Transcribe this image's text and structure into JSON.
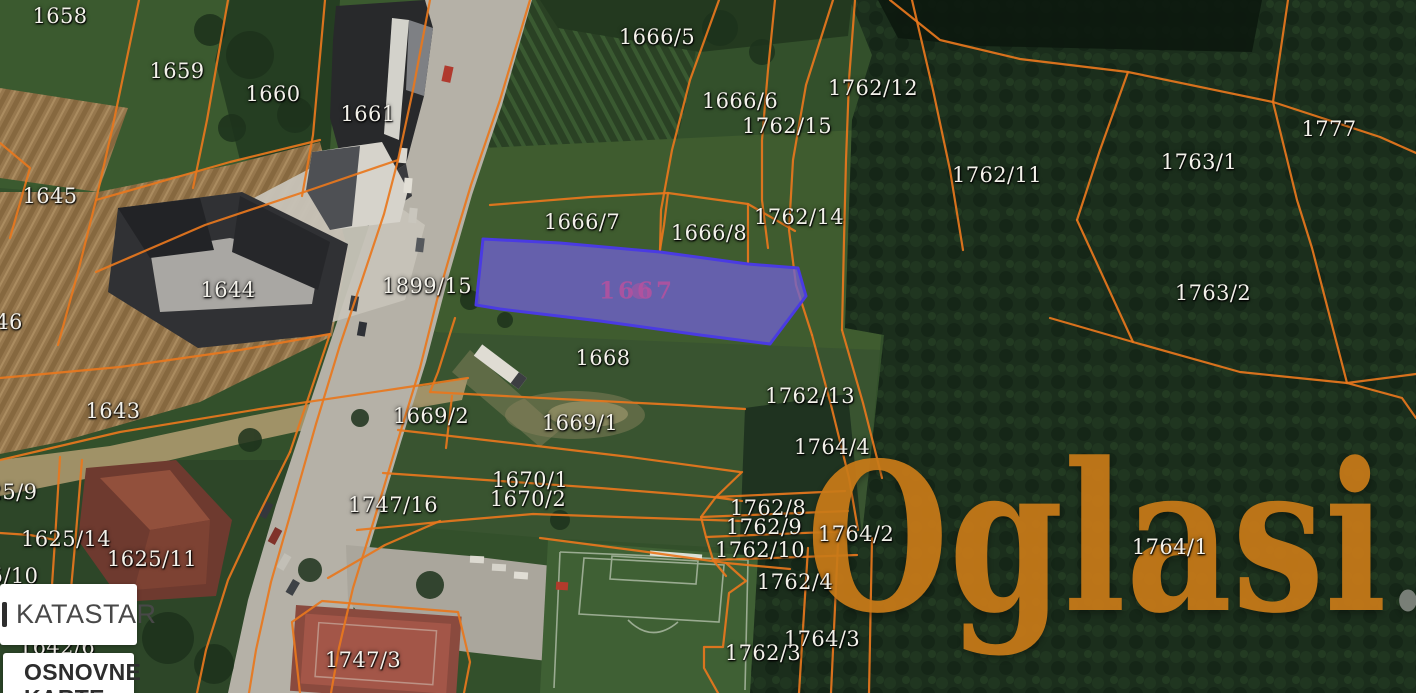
{
  "map": {
    "boundary_color": "#e8771d",
    "label_color": "#f3f1ea",
    "parcel_labels": [
      {
        "id": "1658",
        "x": 60,
        "y": 16
      },
      {
        "id": "1659",
        "x": 177,
        "y": 71
      },
      {
        "id": "1660",
        "x": 273,
        "y": 94
      },
      {
        "id": "1661",
        "x": 368,
        "y": 114
      },
      {
        "id": "1645",
        "x": 50,
        "y": 196
      },
      {
        "id": "46",
        "x": 9,
        "y": 322
      },
      {
        "id": "1644",
        "x": 228,
        "y": 290
      },
      {
        "id": "1899/15",
        "x": 427,
        "y": 286
      },
      {
        "id": "1643",
        "x": 113,
        "y": 411
      },
      {
        "id": "25/9",
        "x": 13,
        "y": 492
      },
      {
        "id": "1625/14",
        "x": 66,
        "y": 539
      },
      {
        "id": "1625/11",
        "x": 152,
        "y": 559
      },
      {
        "id": "5/10",
        "x": 14,
        "y": 576
      },
      {
        "id": "1642/6",
        "x": 57,
        "y": 647
      },
      {
        "id": "1666/5",
        "x": 657,
        "y": 37
      },
      {
        "id": "1666/6",
        "x": 740,
        "y": 101
      },
      {
        "id": "1762/15",
        "x": 787,
        "y": 126
      },
      {
        "id": "1762/12",
        "x": 873,
        "y": 88
      },
      {
        "id": "1762/11",
        "x": 997,
        "y": 175
      },
      {
        "id": "1763/1",
        "x": 1199,
        "y": 162
      },
      {
        "id": "1777",
        "x": 1329,
        "y": 129
      },
      {
        "id": "1763/2",
        "x": 1213,
        "y": 293
      },
      {
        "id": "1666/7",
        "x": 582,
        "y": 222
      },
      {
        "id": "1666/8",
        "x": 709,
        "y": 233
      },
      {
        "id": "1762/14",
        "x": 799,
        "y": 217
      },
      {
        "id": "1668",
        "x": 603,
        "y": 358
      },
      {
        "id": "1669/2",
        "x": 431,
        "y": 416
      },
      {
        "id": "1669/1",
        "x": 580,
        "y": 423
      },
      {
        "id": "1762/13",
        "x": 810,
        "y": 396
      },
      {
        "id": "1764/4",
        "x": 832,
        "y": 447
      },
      {
        "id": "1670/1",
        "x": 530,
        "y": 480
      },
      {
        "id": "1670/2",
        "x": 528,
        "y": 499
      },
      {
        "id": "1747/16",
        "x": 393,
        "y": 505
      },
      {
        "id": "1762/8",
        "x": 768,
        "y": 508
      },
      {
        "id": "1762/9",
        "x": 764,
        "y": 527
      },
      {
        "id": "1762/10",
        "x": 760,
        "y": 550
      },
      {
        "id": "1764/2",
        "x": 856,
        "y": 534
      },
      {
        "id": "1762/4",
        "x": 795,
        "y": 582
      },
      {
        "id": "1764/1",
        "x": 1170,
        "y": 547
      },
      {
        "id": "1764/3",
        "x": 822,
        "y": 639
      },
      {
        "id": "1762/3",
        "x": 763,
        "y": 653
      },
      {
        "id": "1747/3",
        "x": 363,
        "y": 660
      }
    ],
    "highlighted_parcel": {
      "id": "1667",
      "x": 637,
      "y": 291,
      "fill": "#6f61d0",
      "stroke": "#4a3be2",
      "label_color": "#b7519e",
      "points": "483,239 560,243 660,252 748,264 798,268 806,296 770,344 700,335 600,321 500,309 476,305"
    },
    "boundaries": [
      "139,0 112,130 96,200 78,272 58,345",
      "228,0 207,120 193,188",
      "325,0 313,135 302,196",
      "430,0 413,90 398,160 384,214 362,280 340,345 316,424 293,505 271,582 256,650 249,693",
      "530,0 500,100 471,185 452,248 437,300 420,368 398,440 374,520 353,588 339,648 331,693",
      "0,143 30,168 10,238",
      "96,200 230,162 320,140",
      "0,378 120,367 240,350 330,334",
      "0,460 120,432 260,409 395,389 468,378",
      "398,160 310,190 205,225 96,272",
      "490,205 590,197 668,193 748,204 795,231",
      "668,193 664,225 660,250",
      "748,204 748,262",
      "719,0 690,80 672,150 661,210 660,250",
      "775,0 768,70 762,140 762,200 768,248",
      "833,0 806,85 793,160 789,230 796,285 812,335",
      "855,0 849,80 846,160 844,240 842,330",
      "812,335 831,405 849,478 858,530",
      "842,330 863,403 882,478",
      "455,318 438,372 430,392",
      "430,392 560,399 680,405 745,409",
      "452,396 446,448",
      "398,430 520,444 630,457 740,472",
      "383,473 500,481 600,488 713,497 742,501",
      "357,530 450,521 533,514 620,517 742,521",
      "328,578 385,545 440,521",
      "742,472 716,497 701,517 706,537 713,560 726,576",
      "716,497 845,491",
      "701,517 848,511",
      "706,537 852,531",
      "713,560 857,555",
      "540,538 640,551 726,563 790,569",
      "726,563 746,581 729,593 723,647 704,647 704,668 718,693",
      "808,548 799,693",
      "838,543 831,693",
      "872,538 869,693",
      "890,0 940,40 1020,59 1128,72 1273,102",
      "1288,0 1273,102",
      "1273,102 1380,137 1416,153",
      "1273,102 1297,200 1312,248 1347,383",
      "1128,72 1100,150 1077,220",
      "1077,220 1133,342",
      "1050,318 1133,342 1240,372 1347,383",
      "1347,383 1416,374",
      "1347,383 1402,398 1416,418",
      "912,0 933,90 950,170 963,250",
      "60,457 55,540 50,615",
      "82,460 75,545 68,622",
      "0,533 30,535 55,540",
      "290,452 256,520 228,580 206,650 197,693",
      "330,334 290,452",
      "300,693 292,622 322,601 458,612 470,662 464,693"
    ]
  },
  "watermark": {
    "brand": "Oglasi",
    "tld": ".rs",
    "brand_color": "#c87a18",
    "tld_color": "#80857e"
  },
  "panels": {
    "katastar_label": "KATASTAR",
    "layers_label_line1": "OSNOVNE",
    "layers_label_line2": "KARTE"
  }
}
